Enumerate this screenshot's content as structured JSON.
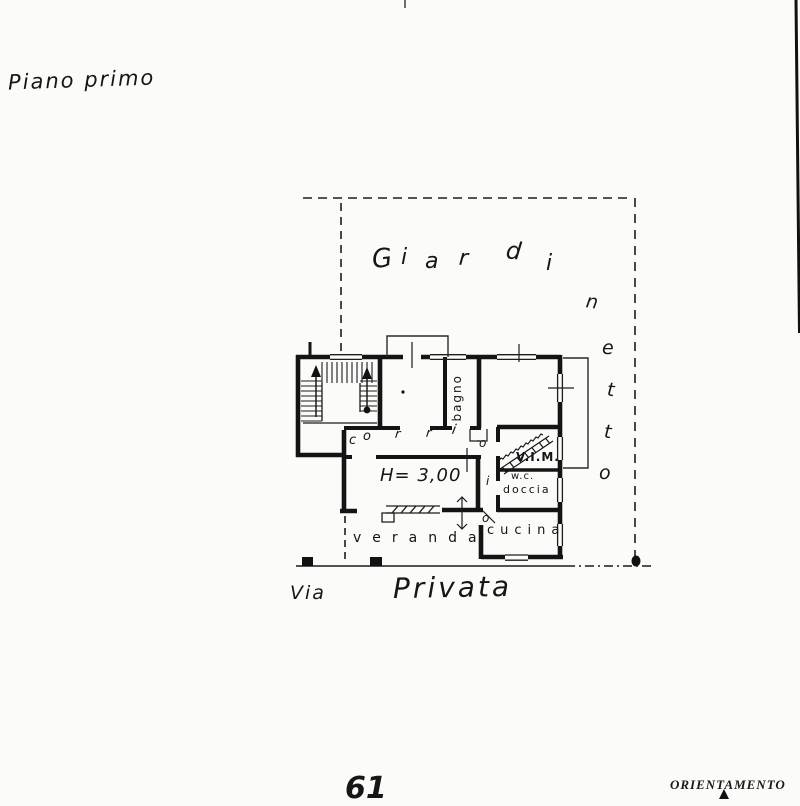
{
  "page": {
    "floor_label": "Piano primo",
    "sheet_number": "61",
    "orientation_label": "ORIENTAMENTO"
  },
  "plan": {
    "garden_label": "Giardinetto",
    "garden_letters_h": [
      "G",
      "i",
      "a",
      "r",
      "d",
      "i"
    ],
    "garden_letters_v": [
      "n",
      "e",
      "t",
      "t",
      "o"
    ],
    "corridor_label": "corridoio",
    "corridor_letters_h": [
      "c",
      "o",
      "r",
      "r",
      "i"
    ],
    "corridor_letters_v": [
      "o",
      "i",
      "o"
    ],
    "rooms": {
      "bagno": "bagno",
      "height_note": "H= 3,00",
      "vim": "V.I.M.",
      "wc_line1": "w.c.",
      "wc_line2": "doccia",
      "cucina": "cucina",
      "veranda": "veranda"
    },
    "street": {
      "via": "Via",
      "privata": "Privata"
    }
  }
}
